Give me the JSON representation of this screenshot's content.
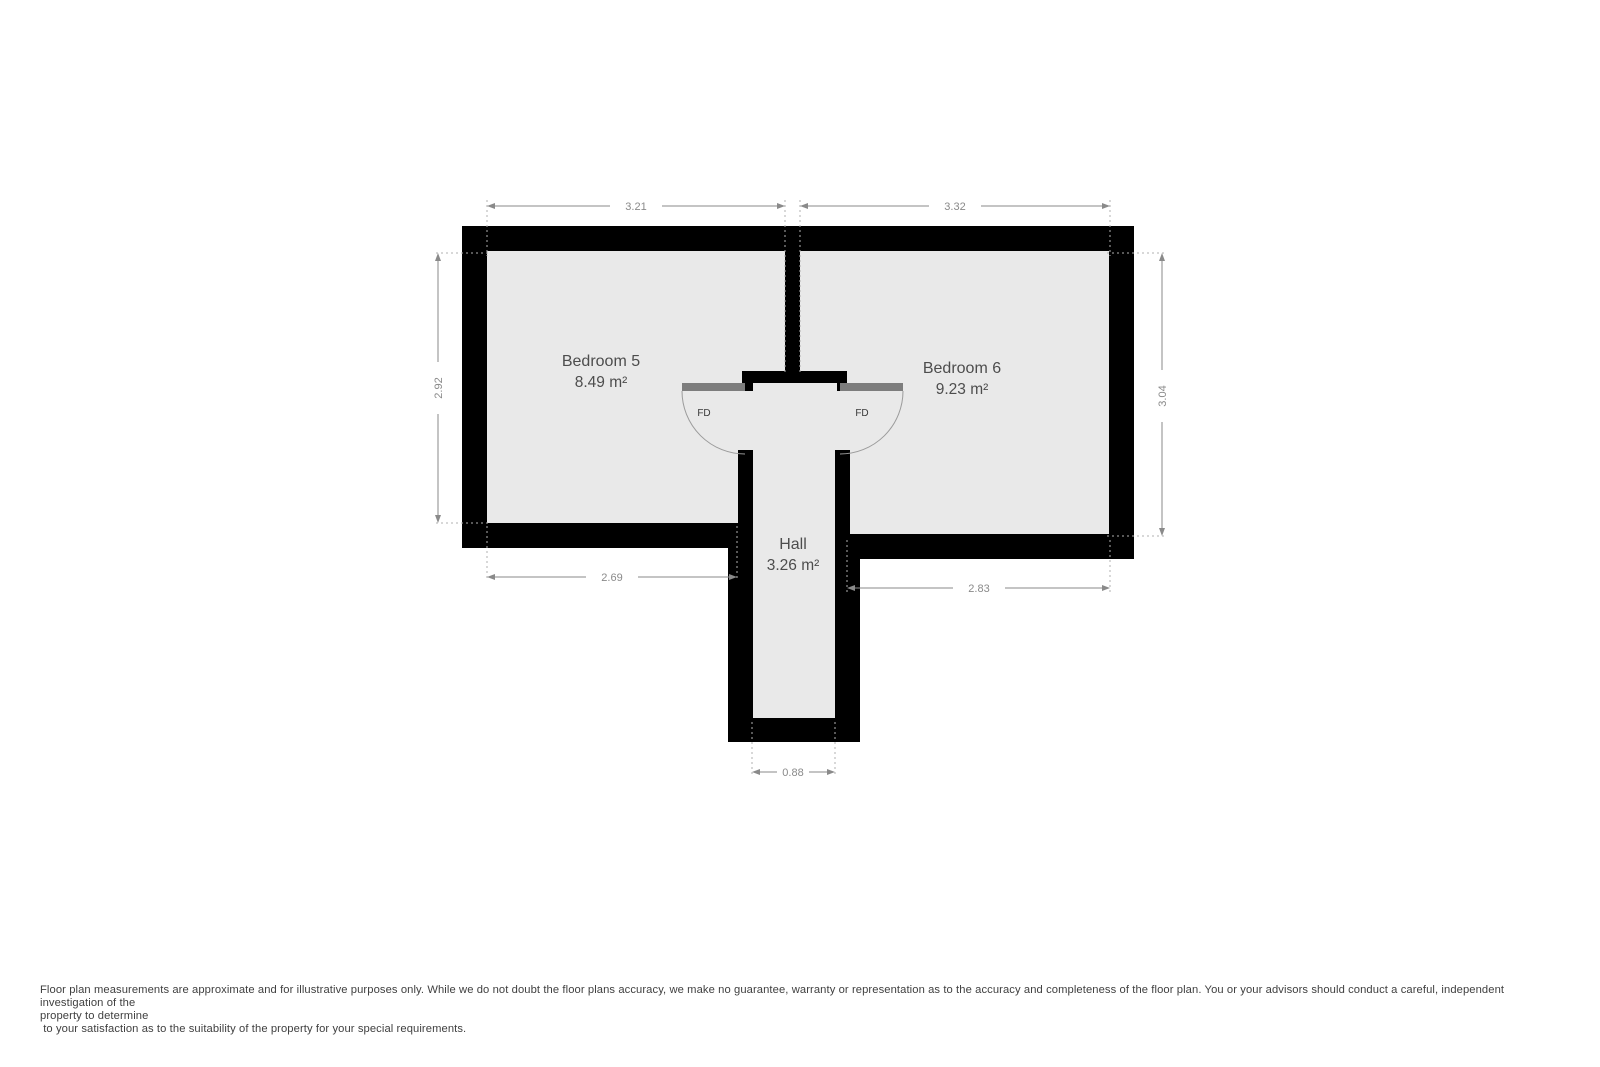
{
  "floorplan": {
    "colors": {
      "wall": "#000000",
      "floor": "#e9e9e9",
      "door_leaf": "#7d7d7d",
      "arc_stroke": "#9b9b9b",
      "dimension": "#8a8a8a",
      "extension": "#b0b0b0",
      "room_label": "#4d4d4d",
      "fd_label": "#383838"
    },
    "rooms": [
      {
        "name": "Bedroom 5",
        "area": "8.49 m²"
      },
      {
        "name": "Bedroom 6",
        "area": "9.23 m²"
      },
      {
        "name": "Hall",
        "area": "3.26 m²"
      }
    ],
    "fire_door_label": "FD",
    "dimensions": {
      "bedroom5_top_width": "3.21",
      "bedroom6_top_width": "3.32",
      "bedroom5_left_height": "2.92",
      "bedroom6_right_height": "3.04",
      "bedroom5_bottom_width": "2.69",
      "bedroom6_bottom_width": "2.83",
      "hall_bottom_width": "0.88"
    }
  },
  "disclaimer": {
    "line1": "Floor plan measurements are approximate and for illustrative purposes only. While we do not doubt the floor plans accuracy, we make no guarantee, warranty or representation as to the accuracy and completeness of the floor plan. You or your advisors should conduct a careful, independent investigation of the",
    "line2": "property to determine",
    "line3": " to your satisfaction as to the suitability of the property for your special requirements."
  }
}
